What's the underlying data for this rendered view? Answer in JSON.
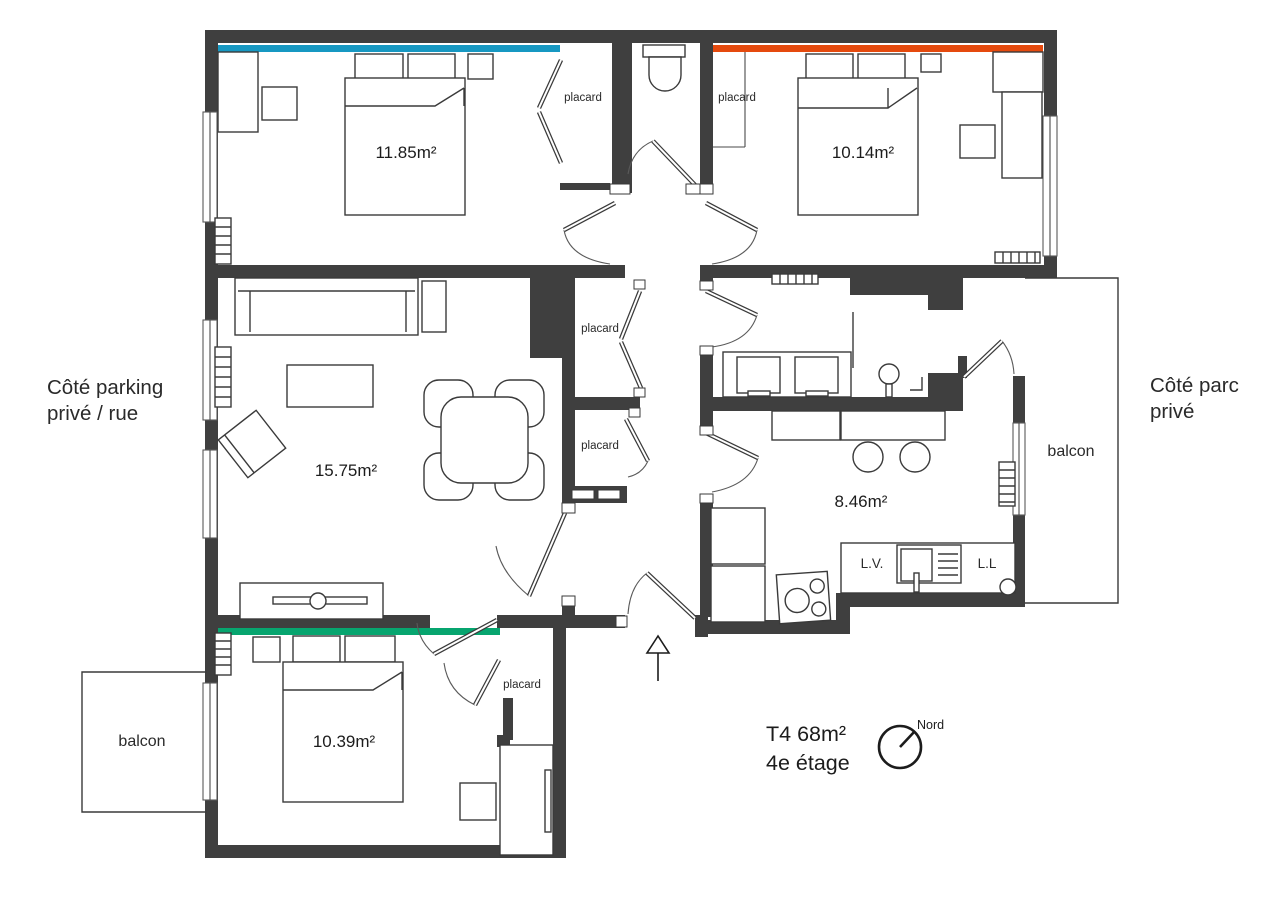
{
  "plan": {
    "type": "apartment-floor-plan",
    "title_line1": "T4 68m²",
    "title_line2": "4e étage",
    "compass_label": "Nord",
    "left_side_line1": "Côté parking",
    "left_side_line2": "privé / rue",
    "right_side_line1": "Côté parc",
    "right_side_line2": "privé",
    "labels": {
      "placard": "placard",
      "balcon": "balcon",
      "dishwasher": "L.V.",
      "washing_machine": "L.L"
    },
    "rooms": {
      "bedroom_top_left": {
        "area": "11.85m²",
        "accent_color": "#1798c2"
      },
      "bedroom_top_right": {
        "area": "10.14m²",
        "accent_color": "#e54a0e"
      },
      "living_room": {
        "area": "15.75m²"
      },
      "kitchen": {
        "area": "8.46m²"
      },
      "bedroom_bottom": {
        "area": "10.39m²",
        "accent_color": "#07a56f"
      }
    }
  }
}
